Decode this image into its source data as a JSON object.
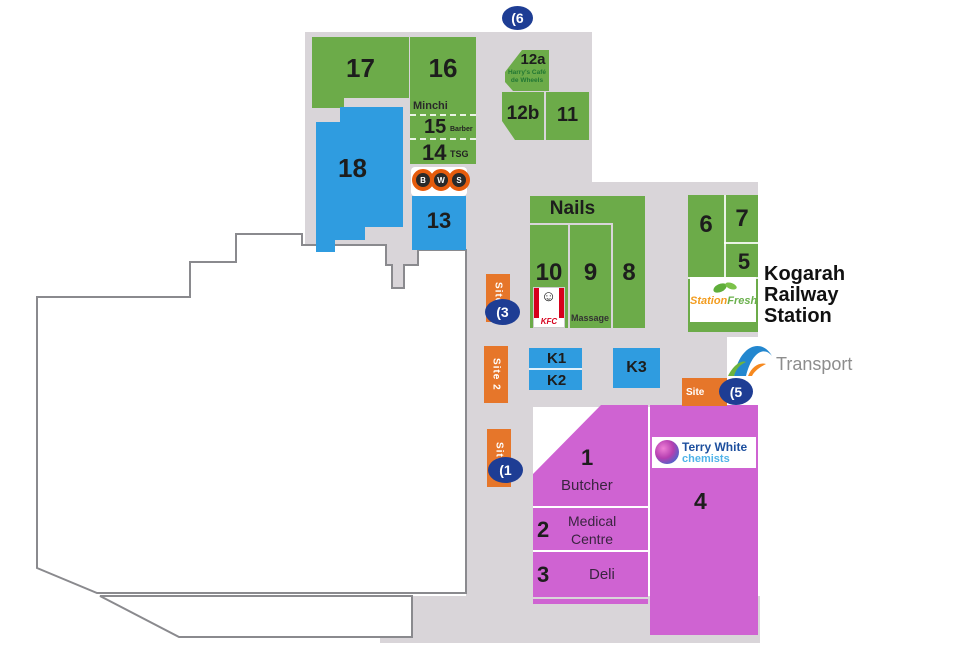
{
  "palette": {
    "corridor": "#d9d5d9",
    "shop_green": "#6cab49",
    "shop_blue": "#2f9ce0",
    "shop_magenta": "#cf63d2",
    "site_orange": "#e6762a",
    "marker_navy": "#1e3d94",
    "woolworths_red": "#e23a3f",
    "tagline_green": "#6cbf47",
    "kfc_red": "#d6001c",
    "terry_blue": "#1d4f9e",
    "terry_light_blue": "#4fb3e8",
    "stationfresh_orange": "#f29c1f",
    "stationfresh_green": "#6ab04c",
    "transport_gray": "#8d8d8d"
  },
  "markers": {
    "top": "(6",
    "site3": "(3",
    "site1": "(1",
    "site5": "(5"
  },
  "sites": {
    "s3": "Site 3",
    "s2": "Site 2",
    "s1": "Site 1",
    "s5": "Site"
  },
  "shops": {
    "n17": "17",
    "n16": "16",
    "minchi": "Minchi",
    "n15": "15",
    "barber": "Barber",
    "n14": "14",
    "tsg": "TSG",
    "n18": "18",
    "n13": "13",
    "n12a": "12a",
    "cafe1": "Harry's Café",
    "cafe2": "de Wheels",
    "n12b": "12b",
    "n11": "11",
    "nails": "Nails",
    "n10": "10",
    "n9": "9",
    "n8": "8",
    "massage": "Massage",
    "n6": "6",
    "n7": "7",
    "n5": "5",
    "k1": "K1",
    "k2": "K2",
    "k3": "K3"
  },
  "market": {
    "n1": "1",
    "name1": "Butcher",
    "n2": "2",
    "name2a": "Medical",
    "name2b": "Centre",
    "n3": "3",
    "name3": "Deli",
    "n4": "4"
  },
  "station": {
    "l1": "Kogarah",
    "l2": "Railway",
    "l3": "Station",
    "transport": "Transport"
  },
  "logos": {
    "bws_b": "B",
    "bws_w": "W",
    "bws_s": "S",
    "kfc": "KFC",
    "woolworths": "Woolworths",
    "tagline": "the fresh food people",
    "sf1": "Station",
    "sf2": "Fresh",
    "tw1": "Terry White",
    "tw2": "chemists"
  }
}
